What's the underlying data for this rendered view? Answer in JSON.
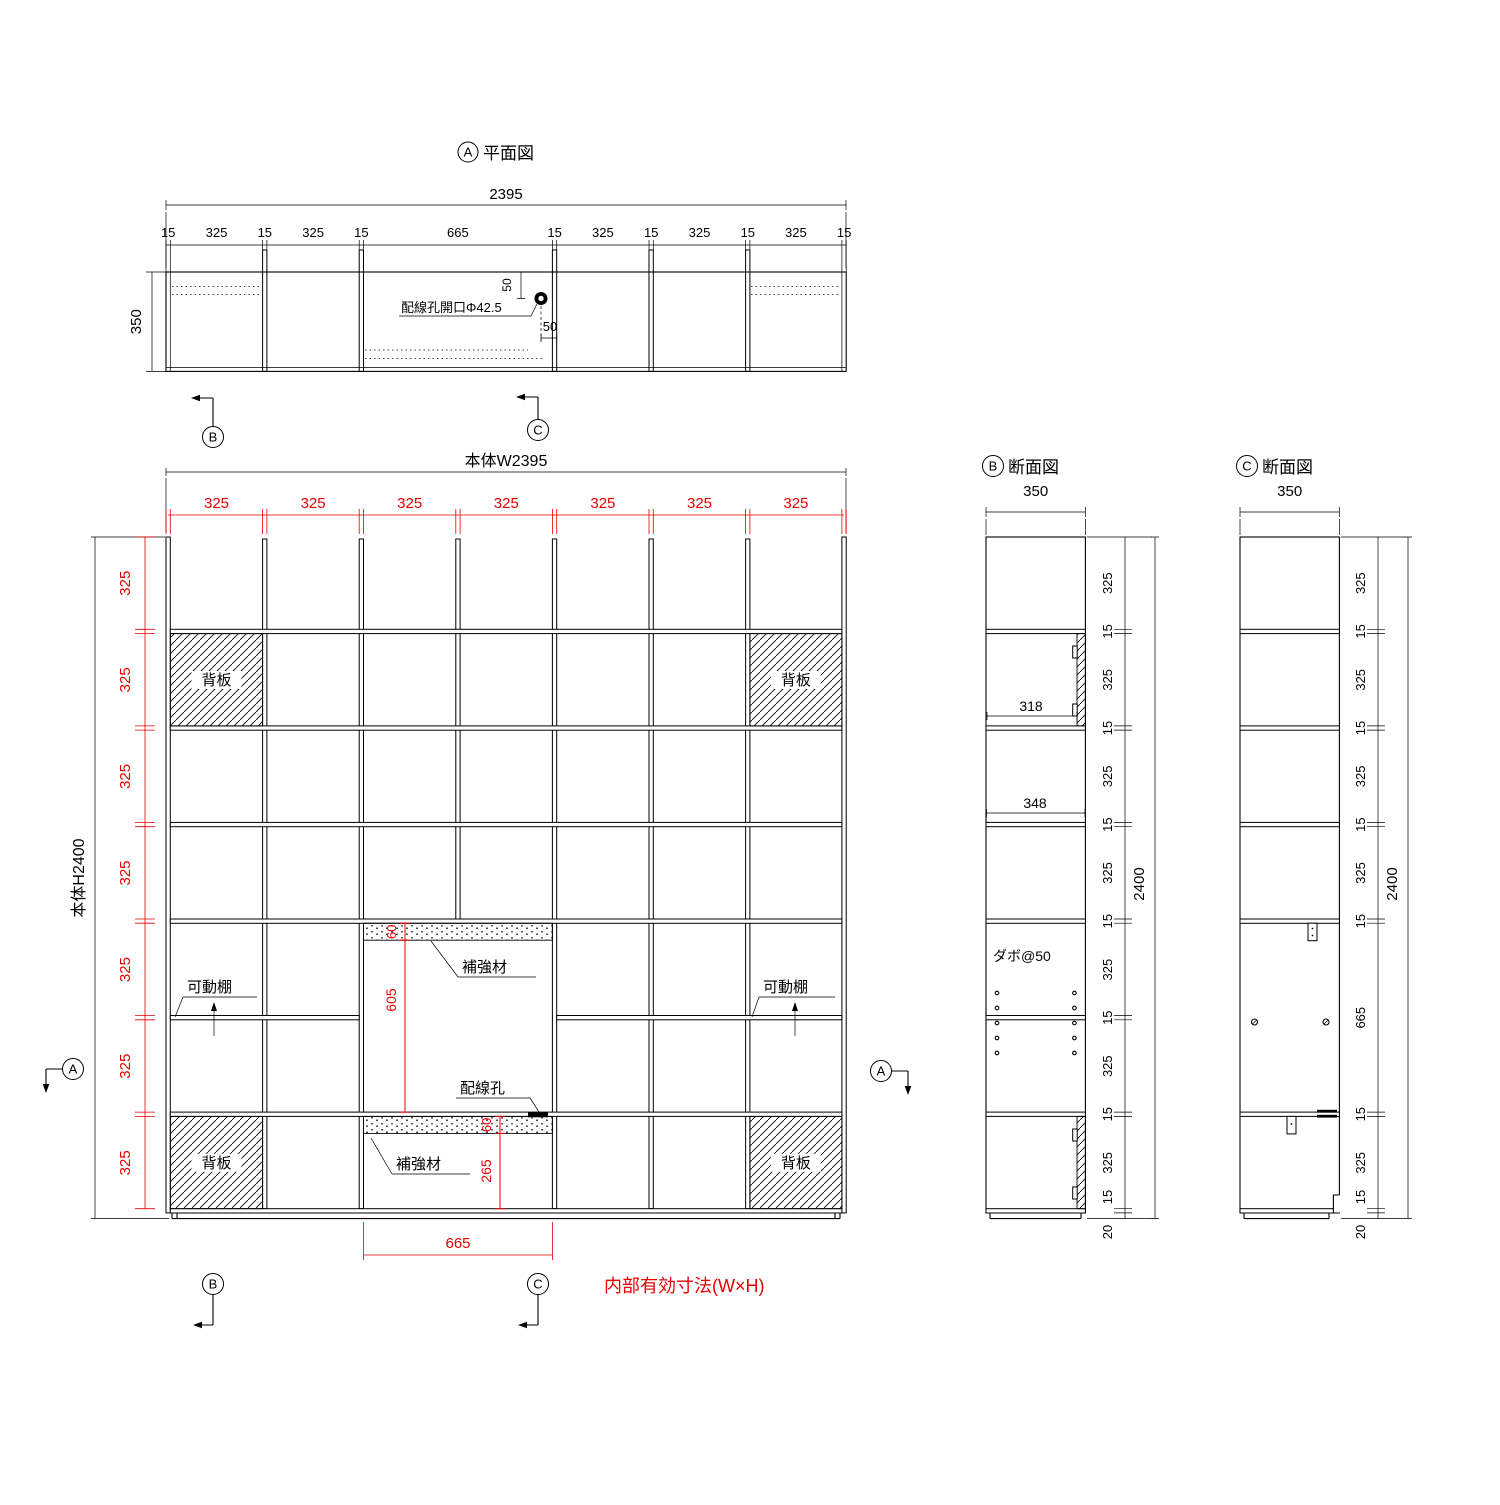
{
  "colors": {
    "dimension_red": "#e60000",
    "line_black": "#000000"
  },
  "plan": {
    "marker": "A",
    "title": "平面図",
    "overall_width": "2395",
    "depth": "350",
    "chain": [
      "15",
      "325",
      "15",
      "325",
      "15",
      "665",
      "15",
      "325",
      "15",
      "325",
      "15",
      "325",
      "15"
    ],
    "hole_label": "配線孔開口Φ42.5",
    "hole_offset_vertical": "50",
    "hole_offset_horizontal": "50",
    "section_marker_b": "B",
    "section_marker_c": "C"
  },
  "elevation": {
    "width_label": "本体W2395",
    "height_label": "本体H2400",
    "column_dims": [
      "325",
      "325",
      "325",
      "325",
      "325",
      "325",
      "325"
    ],
    "row_dims": [
      "325",
      "325",
      "325",
      "325",
      "325",
      "325",
      "325"
    ],
    "back_panel_label": "背板",
    "movable_shelf_label": "可動棚",
    "reinforcement_label": "補強材",
    "wiring_hole_label": "配線孔",
    "reinf_top_height": "60",
    "opening_height": "605",
    "reinf_bottom_height": "60",
    "bottom_clear_height": "265",
    "opening_width": "665",
    "note": "内部有効寸法(W×H)",
    "section_marker_a": "A",
    "section_marker_b": "B",
    "section_marker_c": "C"
  },
  "section_b": {
    "marker": "B",
    "title": "断面図",
    "depth": "350",
    "total_height": "2400",
    "chain": [
      "325",
      "15",
      "325",
      "15",
      "325",
      "15",
      "325",
      "15",
      "325",
      "15",
      "325",
      "15",
      "325",
      "15",
      "20"
    ],
    "inner_depth_back_panel": "318",
    "inner_depth": "348",
    "dowel_label": "ダボ@50"
  },
  "section_c": {
    "marker": "C",
    "title": "断面図",
    "depth": "350",
    "total_height": "2400",
    "chain": [
      "325",
      "15",
      "325",
      "15",
      "325",
      "15",
      "325",
      "15",
      "665",
      "15",
      "325",
      "15",
      "20"
    ]
  }
}
